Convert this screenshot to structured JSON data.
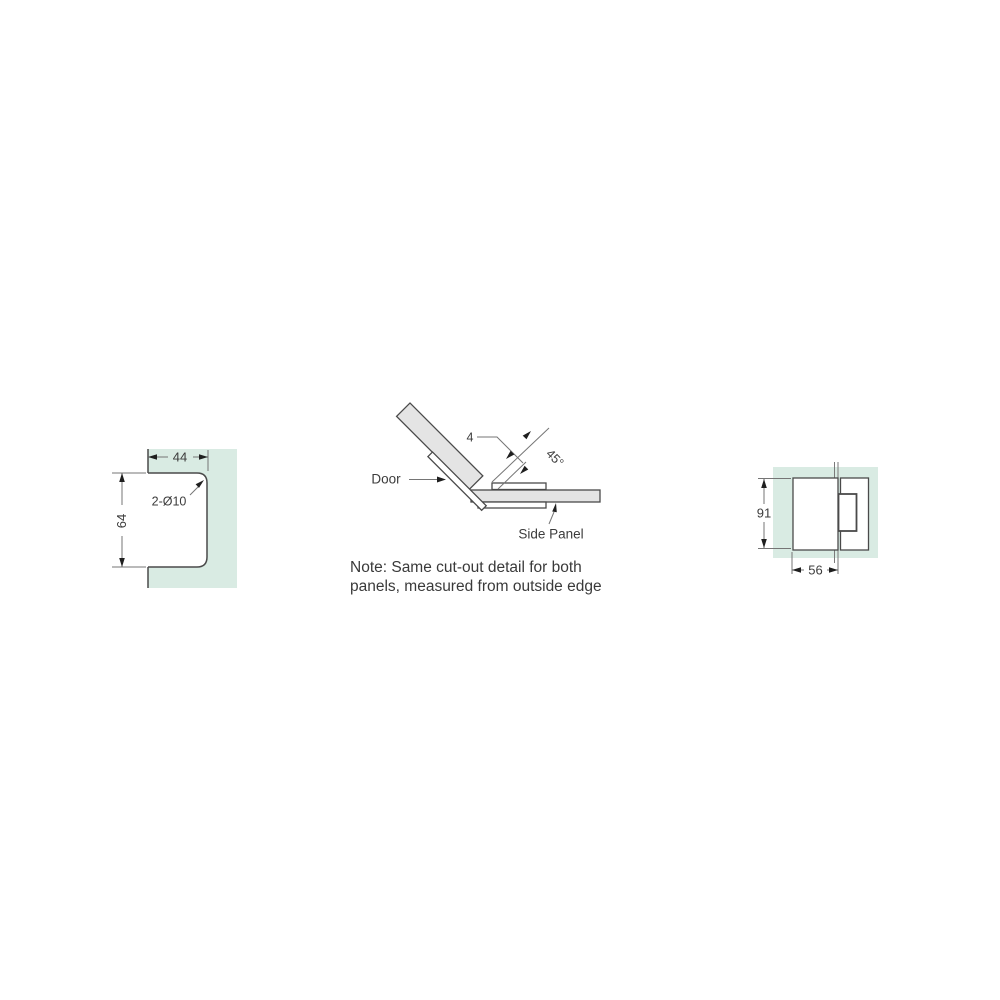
{
  "figures": {
    "cutout_panel": {
      "description": "glass panel cut-out detail, left view",
      "dim_width": "44",
      "dim_height": "64",
      "hole_label": "2-Ø10",
      "panel_color": "#d9ebe3"
    },
    "corner_detail": {
      "description": "135-degree corner joint between door and side panel, plan view",
      "door_label": "Door",
      "side_panel_label": "Side Panel",
      "gap_dim": "4",
      "angle_dim": "45°",
      "note_line1": "Note: Same cut-out detail for both",
      "note_line2": "panels, measured from outside edge"
    },
    "hinge_view": {
      "description": "hinge mounted on glass panel, side elevation",
      "dim_height": "91",
      "dim_width": "56",
      "panel_color": "#d9ebe3"
    }
  },
  "colors": {
    "glass_green": "#d9ebe3",
    "glass_gray": "#e4e4e4",
    "outline": "#4a4a4a",
    "dimension": "#757575",
    "text": "#3c3c3c"
  }
}
